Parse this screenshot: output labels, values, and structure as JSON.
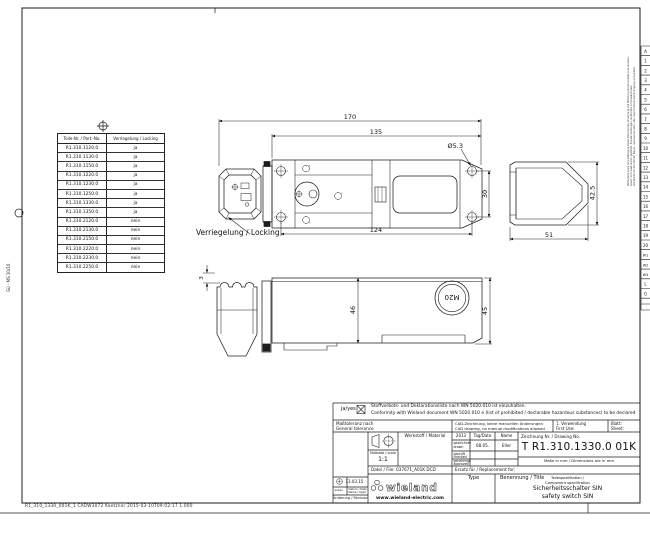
{
  "sheet": {
    "footer_line": "R1_310_1330_001K_1  CADW3072  Koetzner  2015-03-10T09:02:17  1.000",
    "margin_note_left": "Gü - MS 10/10",
    "confidentiality_de": "Weitergabe sowie Vervielfältigung dieses Dokumentes, Verwertung und Mitteilung seines Inhaltes sind verboten, soweit nicht ausdrücklich gestattet. Zuwiderhandlungen verpflichten zu Schadenersatz.",
    "confidentiality_en": "Alle Rechte für den Fall der Patent-, Gebrauchsmuster- oder Geschmacksmustereintragung vorbehalten.",
    "edge_cells": [
      "A",
      "1",
      "2",
      "3",
      "4",
      "5",
      "6",
      "7",
      "8",
      "9",
      "10",
      "11",
      "12",
      "13",
      "14",
      "15",
      "16",
      "17",
      "18",
      "19",
      "20",
      "W1",
      "W2",
      "W3",
      "L",
      "G"
    ]
  },
  "parts_table": {
    "col1_header": "Teile-Nr. / Part.-No.",
    "col2_header": "Verriegelung / Locking",
    "rows": [
      {
        "part": "R1.310.1120.0",
        "locking": "ja"
      },
      {
        "part": "R1.310.1130.0",
        "locking": "ja"
      },
      {
        "part": "R1.310.1150.0",
        "locking": "ja"
      },
      {
        "part": "R1.310.1220.0",
        "locking": "ja"
      },
      {
        "part": "R1.310.1230.0",
        "locking": "ja"
      },
      {
        "part": "R1.310.1250.0",
        "locking": "ja"
      },
      {
        "part": "R1.310.1330.0",
        "locking": "ja"
      },
      {
        "part": "R1.310.1350.0",
        "locking": "ja"
      },
      {
        "part": "R1.310.2120.0",
        "locking": "nein"
      },
      {
        "part": "R1.310.2130.0",
        "locking": "nein"
      },
      {
        "part": "R1.310.2150.0",
        "locking": "nein"
      },
      {
        "part": "R1.310.2220.0",
        "locking": "nein"
      },
      {
        "part": "R1.310.2230.0",
        "locking": "nein"
      },
      {
        "part": "R1.310.2250.0",
        "locking": "nein"
      }
    ]
  },
  "annotations": {
    "locking_label": "Verriegelung / Locking"
  },
  "dimensions": {
    "total_length": "170",
    "body_length": "135",
    "hole_diameter": "Ø5.3",
    "hole_spacing_width": "30",
    "hole_spacing_length": "124",
    "side_width": "51",
    "side_height": "42.5",
    "front_height_body": "46",
    "front_height_end": "45",
    "head_offset": "3",
    "cable_gland": "M20"
  },
  "title_block": {
    "substances_confirm": "ja/yes",
    "substances_de": "Stoffverbots- und Deklarationsliste nach WN 5020.010 ist einzuhalten.",
    "substances_en": "Conformity with Wieland document WN 5020.010 e (list of prohibited / declarable hazardous substances) to be declared",
    "tolerance_de": "Maßtoleranz nach",
    "tolerance_en": "General tolerance",
    "cad_de": "CAD-Zeichnung, keine manuellen Änderungen",
    "cad_en": "CAD drawing, no manual modifications allowed",
    "first_use_de": "1. Verwendung",
    "first_use_en": "First Use:",
    "sheet_de": "Blatt:",
    "sheet_en": "Sheet:",
    "scale_label": "Maßstab / scale",
    "scale_value": "1:1",
    "material_label": "Werkstoff / Material",
    "year": "2013",
    "date_col": "Tag/Date",
    "name_col": "Name",
    "drawn_de": "gezeichnet",
    "drawn_en": "drawn",
    "drawn_date": "08.05.",
    "drawn_name": "Eller",
    "checked_de": "geprüft",
    "checked_en": "checked",
    "approved_de": "genehmigt",
    "approved_en": "approved",
    "drawing_no_label": "Zeichnung Nr. / Drawing No.",
    "drawing_no": "T R1.310.1330.0 01K",
    "units_note": "Maße in mm / Dimensions are in mm",
    "file_label": "Datei / File:",
    "file_value": "037671_A01K.DCD",
    "replacement_label": "Ersatz für / Replacement for:",
    "type_label": "Type",
    "title_label": "Benennung / Title",
    "spec_de": "Teilespezifikation /",
    "spec_en": "Component specification",
    "product_de": "Sicherheitsschalter SIN",
    "product_en": "safety switch SIN",
    "revision_date": "13.03.15",
    "index_label": "Index",
    "rev_date_label": "Datum / Date",
    "rev_name_label": "Name / Appd",
    "revision_label": "Änderung / Revision",
    "brand": "wieland",
    "brand_url": "www.wieland-electric.com"
  }
}
